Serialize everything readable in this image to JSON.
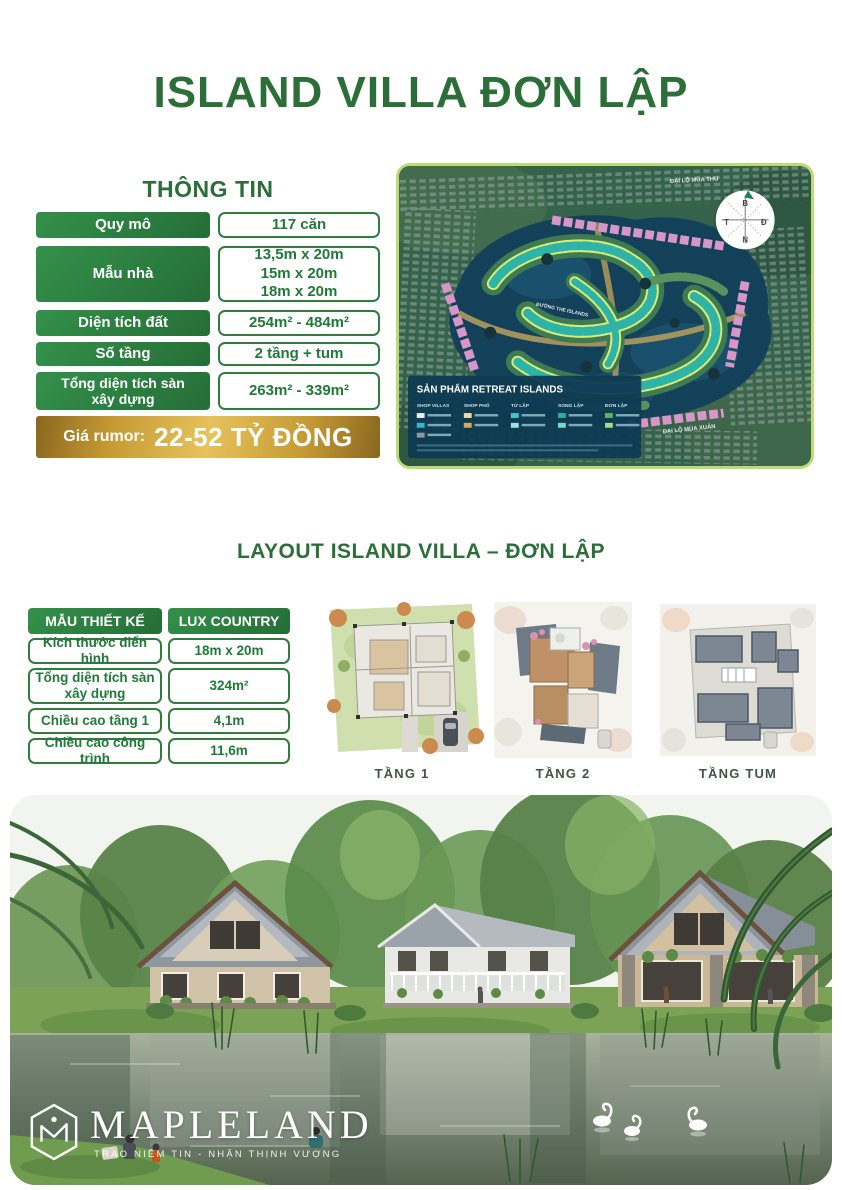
{
  "page": {
    "title": "ISLAND VILLA ĐƠN LẬP"
  },
  "colors": {
    "primary_green": "#2E7D3C",
    "heading_green": "#2C6E38",
    "gold": "#C59A33",
    "map_border": "#BCDC73"
  },
  "info": {
    "heading": "THÔNG TIN",
    "rows": [
      {
        "label": "Quy mô",
        "value": "117 căn"
      },
      {
        "label": "Mẫu nhà",
        "value": "13,5m x 20m\n15m x 20m\n18m x 20m"
      },
      {
        "label": "Diện tích đất",
        "value": "254m² - 484m²"
      },
      {
        "label": "Số tầng",
        "value": "2 tầng + tum"
      },
      {
        "label": "Tổng diện tích sàn\nxây dựng",
        "value": "263m² - 339m²"
      }
    ],
    "price": {
      "prefix": "Giá rumor:",
      "value": "22-52 TỶ ĐỒNG"
    }
  },
  "map": {
    "legend": {
      "title": "SẢN PHẨM RETREAT ISLANDS",
      "columns": [
        "SHOP VILLAS",
        "SHOP PHỐ",
        "TỨ LẬP",
        "SONG LẬP",
        "ĐƠN LẬP"
      ]
    },
    "roads": [
      "ĐẠI LỘ MÙA THU",
      "ĐƯỜNG THE ISLANDS",
      "ĐẠI LỘ MÙA XUÂN"
    ],
    "compass": {
      "n": "B",
      "e": "Đ",
      "s": "N",
      "w": "T"
    }
  },
  "layout": {
    "heading": "LAYOUT ISLAND VILLA – ĐƠN LẬP",
    "table": {
      "header": [
        "MẪU THIẾT KẾ",
        "LUX COUNTRY"
      ],
      "rows": [
        {
          "label": "Kích thước điển hình",
          "value": "18m x 20m"
        },
        {
          "label": "Tổng diện tích sàn\nxây dựng",
          "value": "324m²"
        },
        {
          "label": "Chiều cao tầng 1",
          "value": "4,1m"
        },
        {
          "label": "Chiều cao công trình",
          "value": "11,6m"
        }
      ]
    },
    "plans": [
      {
        "caption": "TẦNG 1"
      },
      {
        "caption": "TẦNG 2"
      },
      {
        "caption": "TẦNG TUM"
      }
    ]
  },
  "footer": {
    "brand": "MAPLELAND",
    "tagline": "TRAO NIỀM TIN - NHẬN THỊNH VƯỢNG"
  }
}
